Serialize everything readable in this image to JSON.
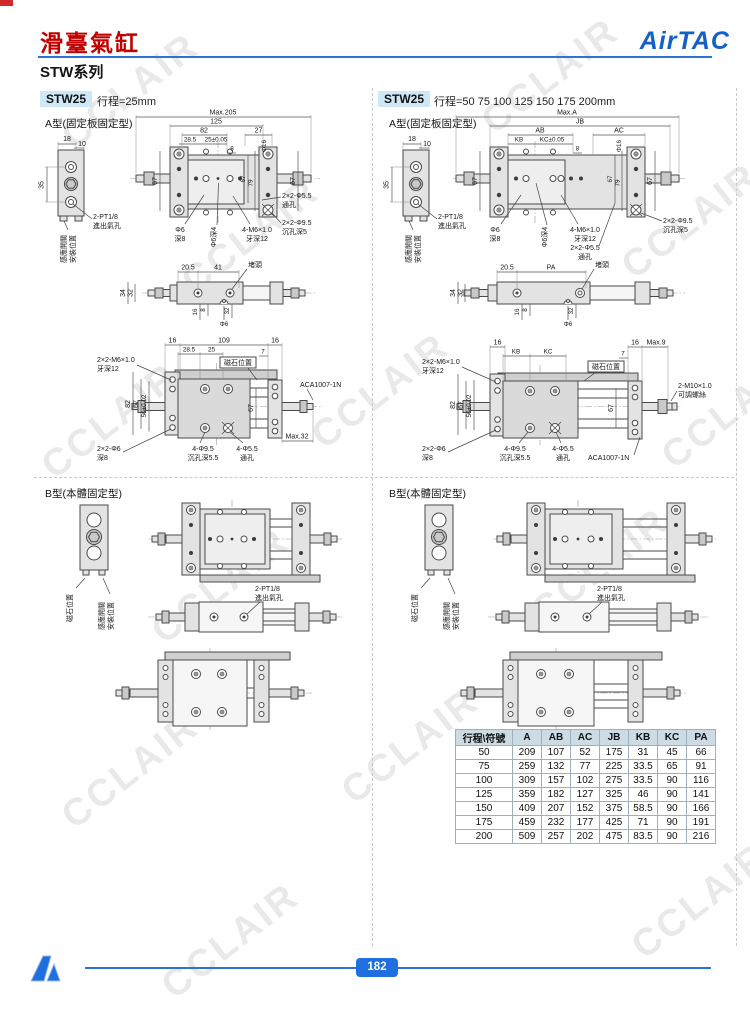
{
  "page": {
    "watermark": "CCLAIR",
    "page_number": "182"
  },
  "header": {
    "title": "滑臺氣缸",
    "series": "STW系列",
    "brand": "AirTAC"
  },
  "sections": {
    "typeA": "A型(固定板固定型)",
    "typeB": "B型(本體固定型)"
  },
  "left": {
    "model": "STW25",
    "stroke": "行程=25mm"
  },
  "right": {
    "model": "STW25",
    "stroke": "行程=50 75 100 125 150 175 200mm"
  },
  "d": {
    "n18": "18",
    "n10": "10",
    "n35": "35",
    "n67": "67",
    "n79": "79",
    "n8": "8",
    "n16": "16",
    "n7": "7",
    "n205": "20.5",
    "n41": "41",
    "n34": "34",
    "n32": "32",
    "n285": "28.5",
    "n109": "109",
    "n125": "125",
    "n82": "82",
    "n27": "27",
    "n25t": "25±0.05",
    "n25": "25",
    "n50t": "50±0.02",
    "max205": "Max.205",
    "max32": "Max.32",
    "maxA": "Max.A",
    "max9": "Max.9",
    "jb": "JB",
    "ab": "AB",
    "ac": "AC",
    "kb": "KB",
    "kc": "KC",
    "kct": "KC±0.05",
    "pa": "PA",
    "phi16": "Φ16",
    "phi6": "Φ6",
    "deep8": "深8",
    "phi6d4": "Φ6深4",
    "phi6x": "2×2-Φ6",
    "port": "2-PT1/8",
    "port2": "進出氣孔",
    "m6": "4-M6×1.0",
    "m6b": "牙深12",
    "m6x": "2×2-M6×1.0",
    "h55": "2×2-Φ5.5",
    "h55b": "通孔",
    "h95": "2×2-Φ9.5",
    "h95b": "沉孔深5",
    "h95c": "4-Φ9.5",
    "h95d": "沉孔深5.5",
    "h55c": "4-Φ5.5",
    "m10": "2-M10×1.0",
    "m10b": "可調螺絲",
    "aca": "ACA1007-1N",
    "plug": "堵頭",
    "magnet": "磁石位置",
    "sensor1": "感應開關",
    "sensor2": "安裝位置"
  },
  "table": {
    "headers": [
      "行程\\符號",
      "A",
      "AB",
      "AC",
      "JB",
      "KB",
      "KC",
      "PA"
    ],
    "rows": [
      [
        "50",
        "209",
        "107",
        "52",
        "175",
        "31",
        "45",
        "66"
      ],
      [
        "75",
        "259",
        "132",
        "77",
        "225",
        "33.5",
        "65",
        "91"
      ],
      [
        "100",
        "309",
        "157",
        "102",
        "275",
        "33.5",
        "90",
        "116"
      ],
      [
        "125",
        "359",
        "182",
        "127",
        "325",
        "46",
        "90",
        "141"
      ],
      [
        "150",
        "409",
        "207",
        "152",
        "375",
        "58.5",
        "90",
        "166"
      ],
      [
        "175",
        "459",
        "232",
        "177",
        "425",
        "71",
        "90",
        "191"
      ],
      [
        "200",
        "509",
        "257",
        "202",
        "475",
        "83.5",
        "90",
        "216"
      ]
    ]
  }
}
